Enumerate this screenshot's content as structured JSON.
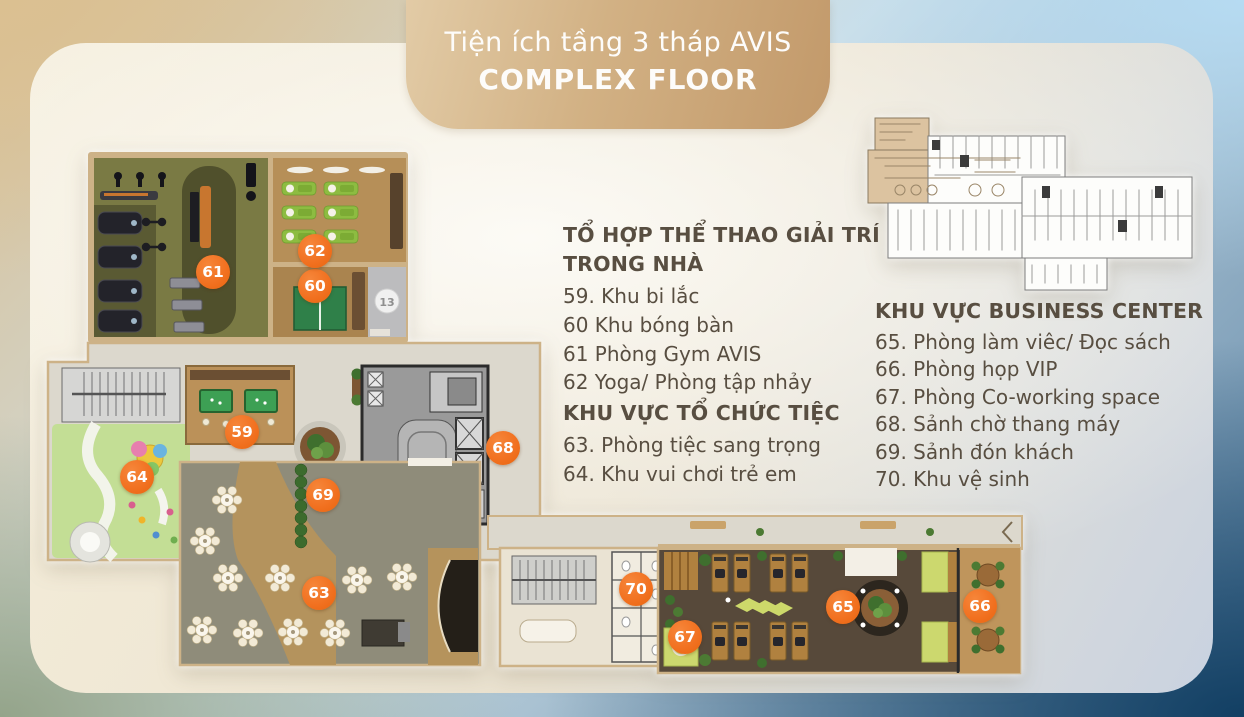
{
  "title": {
    "line1": "Tiện ích tầng 3 tháp AVIS",
    "line2": "COMPLEX FLOOR"
  },
  "legend": {
    "sports": {
      "heading": "TỔ HỢP THỂ THAO GIẢI TRÍ TRONG NHÀ",
      "items": [
        "59. Khu bi lắc",
        "60 Khu bóng bàn",
        "61 Phòng Gym AVIS",
        "62 Yoga/ Phòng tập nhảy"
      ]
    },
    "party": {
      "heading": "KHU VỰC TỔ CHỨC TIỆC",
      "items": [
        "63. Phòng tiệc sang trọng",
        "64. Khu vui chơi trẻ em"
      ]
    },
    "business": {
      "heading": "KHU VỰC BUSINESS CENTER",
      "items": [
        "65. Phòng làm viêc/ Đọc sách",
        "66. Phòng họp VIP",
        "67. Phòng Co-working space",
        "68. Sảnh chờ thang máy",
        "69. Sảnh đón khách",
        "70. Khu vệ sinh"
      ]
    }
  },
  "plan": {
    "markers": [
      {
        "label": "59"
      },
      {
        "label": "60"
      },
      {
        "label": "61"
      },
      {
        "label": "62"
      },
      {
        "label": "63"
      },
      {
        "label": "64"
      },
      {
        "label": "65"
      },
      {
        "label": "66"
      },
      {
        "label": "67"
      },
      {
        "label": "68"
      },
      {
        "label": "69"
      },
      {
        "label": "70"
      }
    ],
    "column_badge": "13",
    "marker_color": "#f1701f"
  },
  "colors": {
    "banner_gold": "#c9a06e",
    "accent_orange": "#f1701f",
    "text_dark": "#584e41"
  }
}
